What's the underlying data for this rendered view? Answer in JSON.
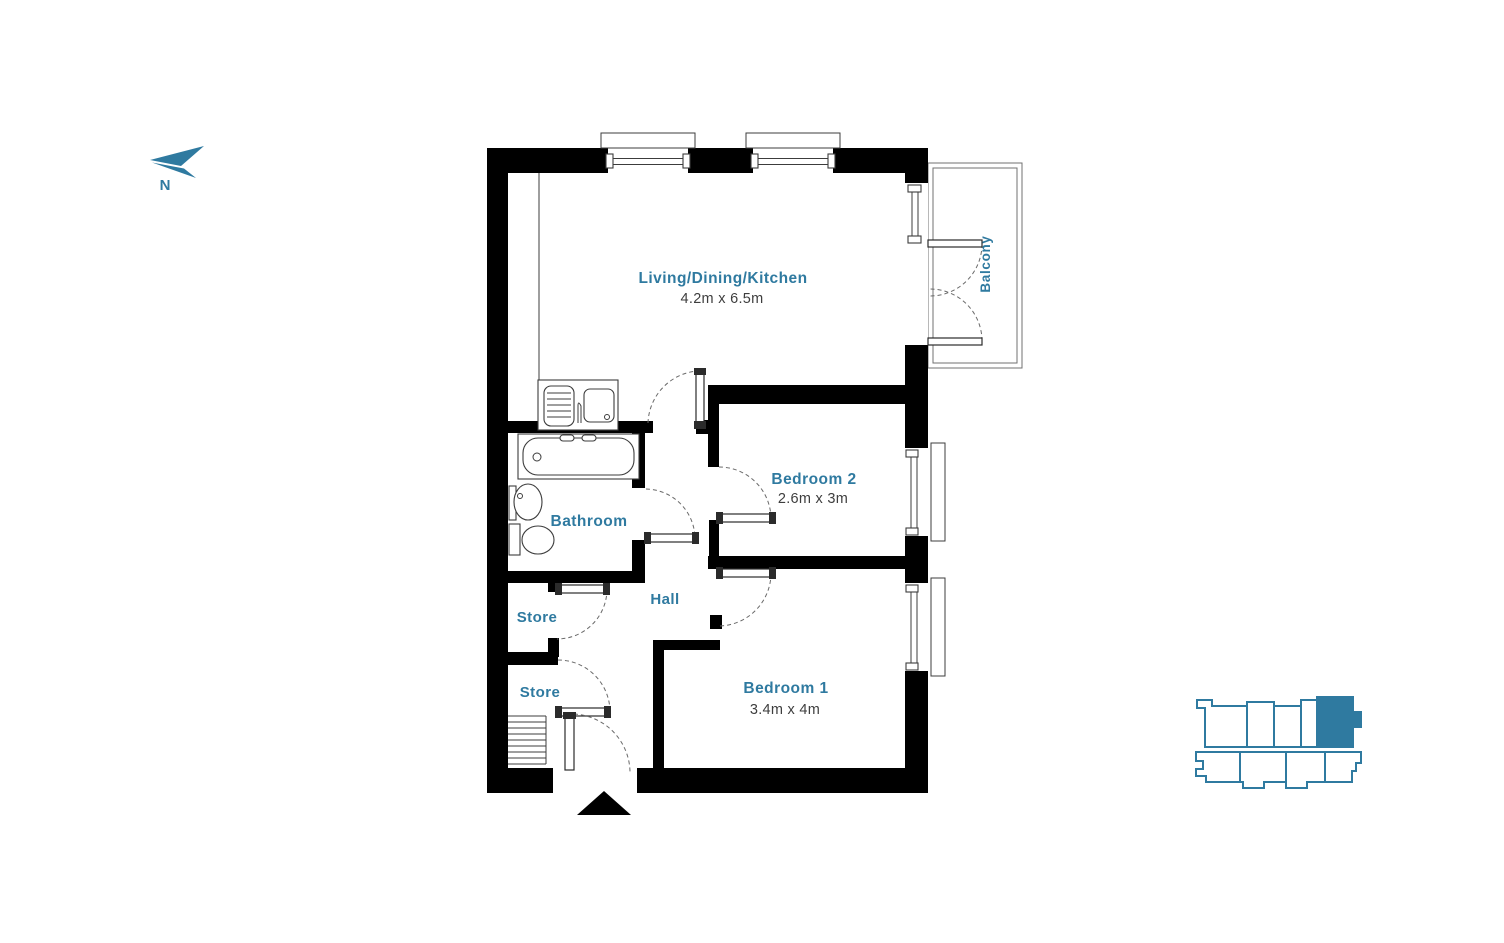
{
  "colors": {
    "accent": "#2F7AA0",
    "wall": "#000000",
    "dimension_text": "#3E3E3E"
  },
  "north_indicator": {
    "label": "N"
  },
  "rooms": {
    "living_dining_kitchen": {
      "name": "Living/Dining/Kitchen",
      "dimensions": "4.2m x 6.5m"
    },
    "balcony": {
      "name": "Balcony"
    },
    "bedroom_2": {
      "name": "Bedroom 2",
      "dimensions": "2.6m x 3m"
    },
    "bathroom": {
      "name": "Bathroom"
    },
    "hall": {
      "name": "Hall"
    },
    "store_upper": {
      "name": "Store"
    },
    "store_lower": {
      "name": "Store"
    },
    "bedroom_1": {
      "name": "Bedroom 1",
      "dimensions": "3.4m x 4m"
    }
  },
  "fixtures": [
    "kitchen-sink",
    "bathtub",
    "washbasin",
    "toilet",
    "stairs-hatch",
    "entrance-marker"
  ],
  "key_plan": {
    "highlighted_unit": "top-right"
  }
}
